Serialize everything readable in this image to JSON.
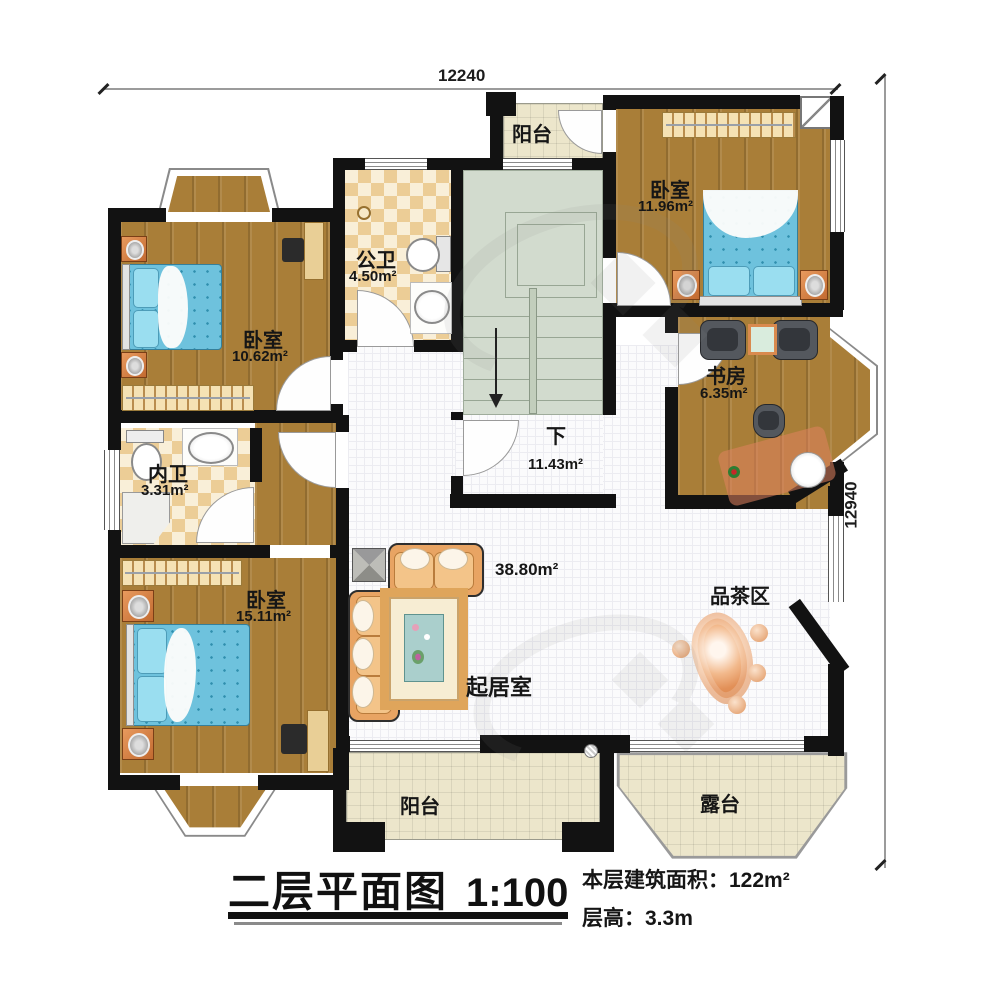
{
  "dimensions": {
    "top": "12240",
    "right": "12940"
  },
  "titleblock": {
    "title": "二层平面图",
    "scale": "1:100",
    "area_line": "本层建筑面积：122m²",
    "height_line": "层高：3.3m"
  },
  "rooms": {
    "balcony_top": {
      "name": "阳台"
    },
    "bedroom_top_right": {
      "name": "卧室",
      "area": "11.96m²"
    },
    "public_bath": {
      "name": "公卫",
      "area": "4.50m²"
    },
    "bedroom_left": {
      "name": "卧室",
      "area": "10.62m²"
    },
    "study": {
      "name": "书房",
      "area": "6.35m²"
    },
    "private_bath": {
      "name": "内卫",
      "area": "3.31m²"
    },
    "stair_hall": {
      "name": "下",
      "area": "11.43m²"
    },
    "bedroom_bottom_left": {
      "name": "卧室",
      "area": "15.11m²"
    },
    "living_room": {
      "name": "起居室",
      "area": "38.80m²"
    },
    "tea_area": {
      "name": "品茶区"
    },
    "balcony_bottom": {
      "name": "阳台"
    },
    "terrace": {
      "name": "露台"
    }
  },
  "colors": {
    "wall": "#121212",
    "wood_floor": "#a97e38",
    "bed_blue": "#6ec2dd",
    "bath_tile": "#eccd96",
    "balcony_tile": "#ece6cb",
    "stair_green": "#d2dbce",
    "sofa_tan": "#e8a463",
    "accent_orange": "#d08448"
  }
}
